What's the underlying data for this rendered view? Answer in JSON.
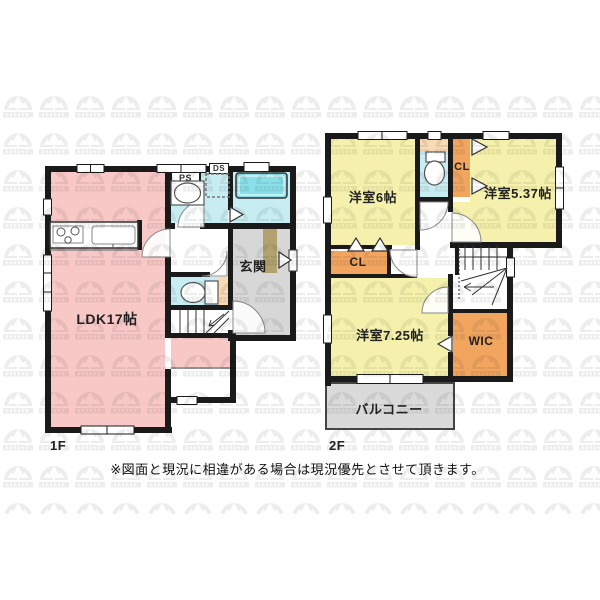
{
  "disclaimer": "※図面と現況に相違がある場合は現況優先とさせて頂きます。",
  "floor1": {
    "label": "1F",
    "ldk": "LDK17帖",
    "genkan": "玄関",
    "ps": "PS",
    "ds": "DS"
  },
  "floor2": {
    "label": "2F",
    "room6": "洋室6帖",
    "room537": "洋室5.37帖",
    "room725": "洋室7.25帖",
    "cl_right": "CL",
    "cl_left": "CL",
    "wic": "WIC",
    "balcony": "バルコニー"
  },
  "colors": {
    "wall": "#1a1a1a",
    "room_pink": "#f8c8c6",
    "room_yellow": "#f5f1ac",
    "wet_cyan": "#c7edf3",
    "tub_cyan": "#8adfe9",
    "closet_orange": "#f1a55e",
    "shelf_peach": "#f8dab4",
    "entry_gray": "#d7d7d7",
    "balcony_gray": "#dadada",
    "step_tan": "#b2a26f"
  }
}
